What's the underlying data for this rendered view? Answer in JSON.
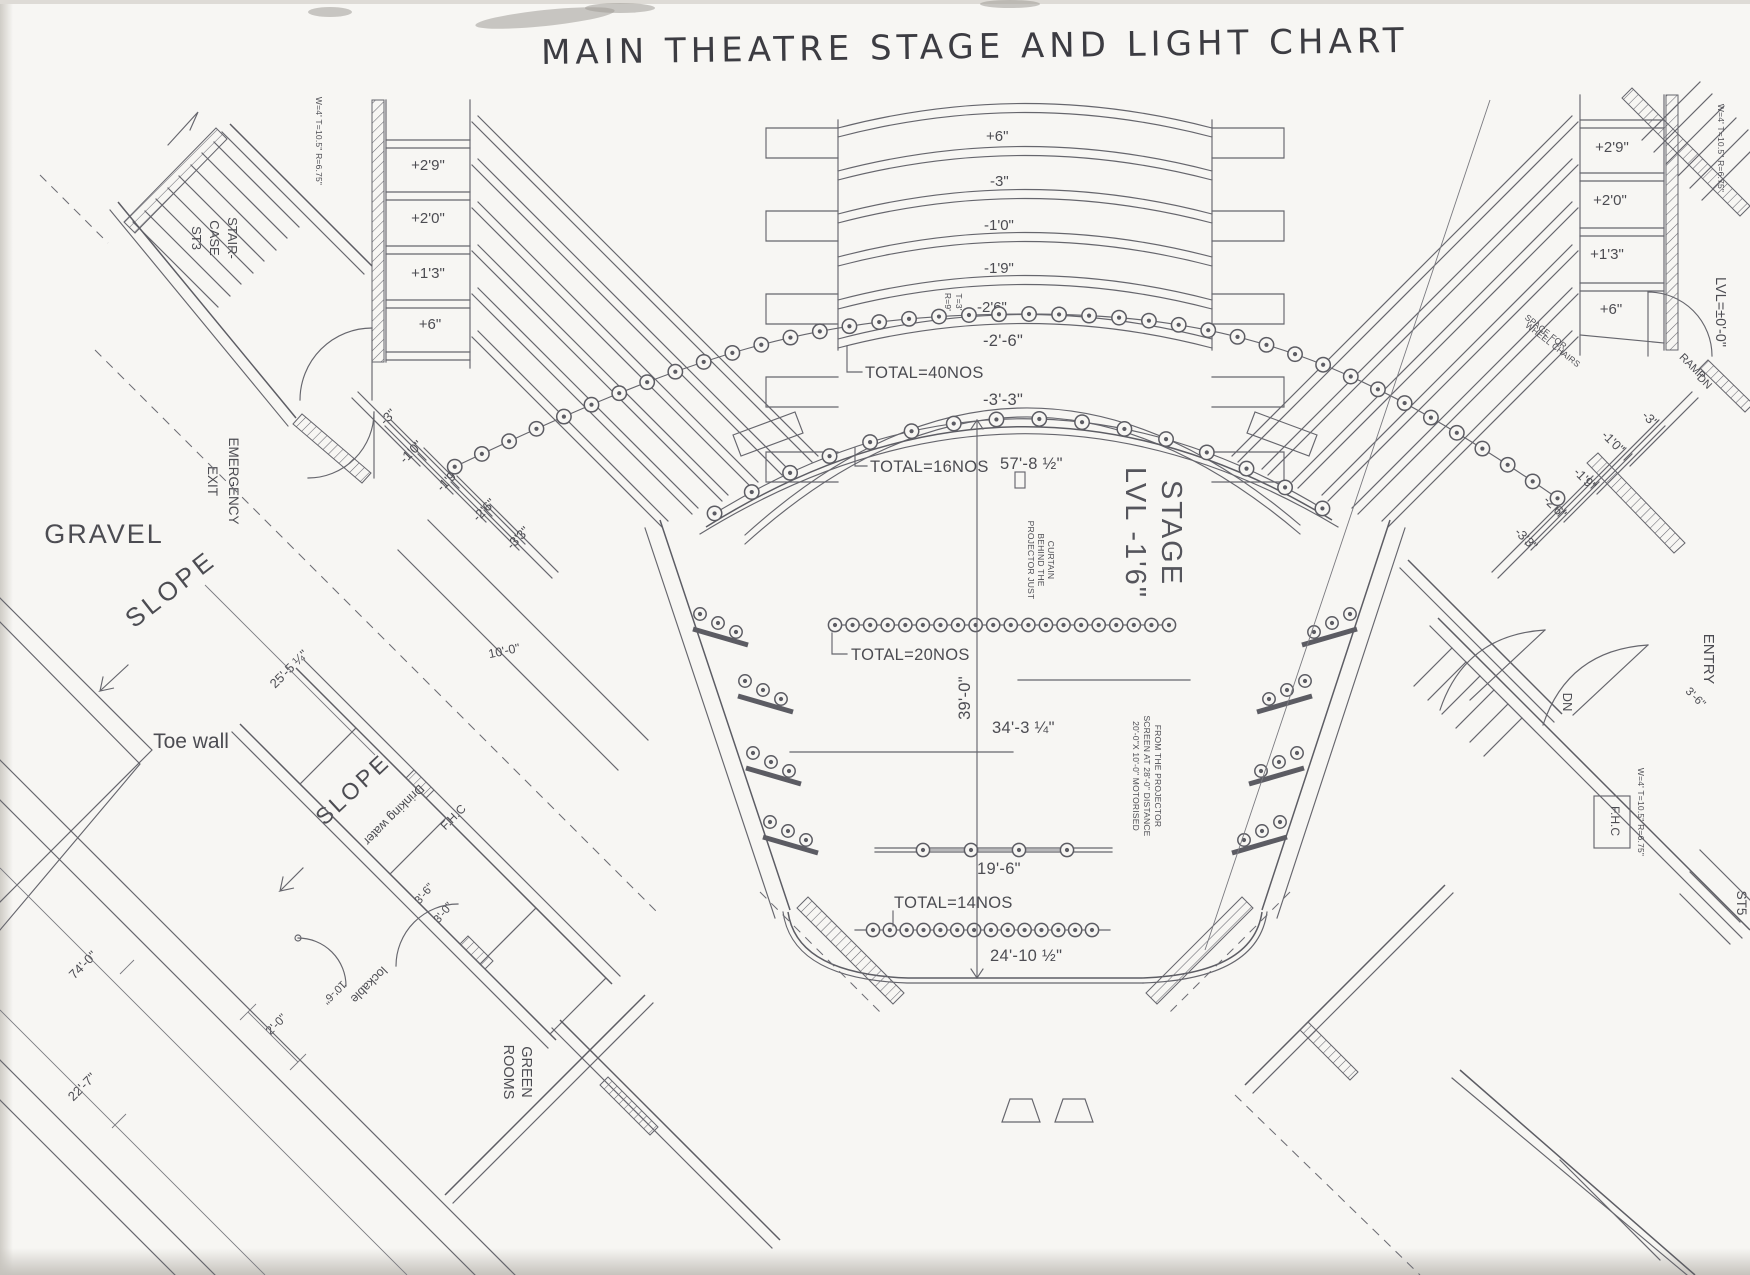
{
  "title": "MAIN THEATRE STAGE AND LIGHT CHART",
  "seating": {
    "left_platform_labels": [
      "+2'9\"",
      "+2'0\"",
      "+1'3\"",
      "+6\""
    ],
    "right_platform_labels": [
      "+2'9\"",
      "+2'0\"",
      "+1'3\"",
      "+6\""
    ],
    "center_row_labels": [
      "+6\"",
      "-3\"",
      "-1'0\"",
      "-1'9\"",
      "-2'6\""
    ],
    "left_wing_labels": [
      "-3\"",
      "-1'0\"",
      "-1'9\"",
      "-2'6\"",
      "-3'3\""
    ],
    "right_wing_labels": [
      "-3\"",
      "-1'0\"",
      "-1'9\"",
      "-2'6\"",
      "-3'3\""
    ],
    "wheelchair_note": [
      "SPACE FOR",
      "WHEEL CHAIRS"
    ],
    "lvl_zero": "LVL=±0'-0\""
  },
  "lights": {
    "row1": {
      "label": "TOTAL=40NOS",
      "count": 40,
      "note": [
        "T=3'",
        "R=9'"
      ],
      "dim": "-2'-6\""
    },
    "row2": {
      "label": "TOTAL=16NOS",
      "count": 16,
      "dim": "-3'-3\""
    },
    "row3": {
      "label": "TOTAL=20NOS",
      "count": 20
    },
    "row4": {
      "count": 4,
      "dim": "19'-6\""
    },
    "row5": {
      "label": "TOTAL=14NOS",
      "count": 14,
      "dim": "24'-10 ½\""
    }
  },
  "stage": {
    "name": [
      "STAGE",
      "LVL -1'6\""
    ],
    "width_back": "57'-8 ½\"",
    "depth": "39'-0\"",
    "screen_width": "34'-3 ¼\"",
    "projector_note": [
      "PROJECTOR JUST",
      "BEHIND THE",
      "CURTAIN"
    ],
    "screen_note": [
      "20'-0\"X 10'-0\" MOTORISED",
      "SCREEN AT 28'-0\" DISTANCE",
      "FROM THE PROJECTOR"
    ]
  },
  "site": {
    "gravel": "GRAVEL",
    "slope_upper": "SLOPE",
    "slope_lower": "SLOPE",
    "toe_wall": "Toe wall",
    "dim_25_5": "25'-5 ¼\"",
    "dim_74": "74'-0\"",
    "dim_22_7": "22'-7\"",
    "dim_2_0": "2'-0\"",
    "dim_10_0": "10'-0\""
  },
  "rooms": {
    "emergency_exit": [
      "EMERGENCY",
      "EXIT"
    ],
    "green_rooms": [
      "GREEN",
      "ROOMS"
    ],
    "drinking_water": "Drinking water",
    "fhc_left": "F.H.C",
    "fhc_right": "F.H.C",
    "lockable": "lockable",
    "dim_10_6": "10'-6\"",
    "dim_3_6_left": "3'-6\"",
    "dim_3_0_left": "3'-0\"",
    "entry": "ENTRY",
    "dim_3_6_right": "3'-6\"",
    "dn": "DN",
    "ramp": [
      "RAMP",
      "DN"
    ]
  },
  "stairs": {
    "st3": [
      "STAIR-",
      "CASE",
      "ST3"
    ],
    "st3_spec": "W=4' T=10.5\" R=6.75\"",
    "st4_spec": "W=4' T=10.5\" R=6.75\"",
    "st5": "ST5",
    "st5_spec": "W=4' T=10.5\" R=6.75\""
  }
}
